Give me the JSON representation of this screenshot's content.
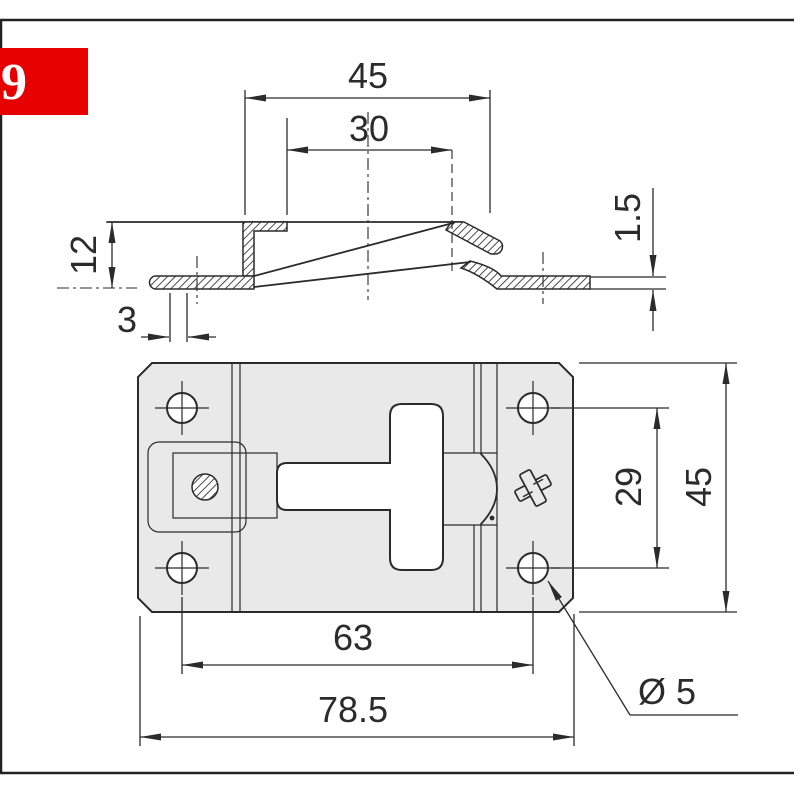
{
  "tag_box": {
    "label": "9",
    "bg_color": "#e60000",
    "text_color": "#ffffff"
  },
  "drawing": {
    "kind": "technical-drawing",
    "side_view": {
      "overall_width": "45",
      "inner_width": "30",
      "height": "12",
      "slot_width": "3",
      "material_thickness": "1.5"
    },
    "plan_view": {
      "hole_pitch_vertical": "29",
      "plate_depth": "45",
      "hole_pitch_horizontal": "63",
      "overall_length": "78.5",
      "hole_diameter_label": "Ø 5"
    }
  },
  "colors": {
    "line": "#2b2b2b",
    "plate_fill": "#e9e9e9",
    "accent_red": "#e60000"
  }
}
